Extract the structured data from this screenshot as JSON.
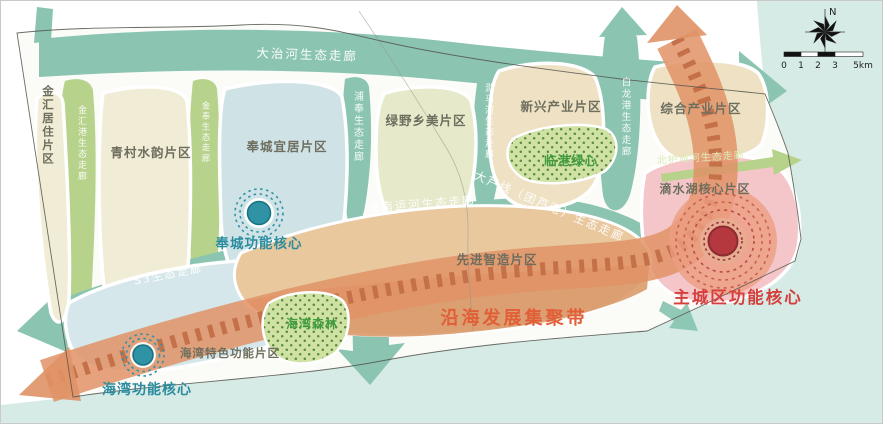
{
  "regions": {
    "jinhui_residential": "金汇居住片区",
    "qingcun_water": "青村水韵片区",
    "fengcheng_livable": "奉城宜居片区",
    "lvye_rural": "绿野乡美片区",
    "xinxing_industry": "新兴产业片区",
    "zonghe_industry": "综合产业片区",
    "dishuihu_core_area": "滴水湖核心片区",
    "advanced_manufacturing": "先进智造片区",
    "haiwan_special": "海湾特色功能片区"
  },
  "corridors": {
    "dazhihe": "大治河生态走廊",
    "jinhuigang": "金汇港生态走廊",
    "jinfeng": "金奉生态走廊",
    "pufeng": "浦奉生态走廊",
    "lemahe": "泐马河生态走廊",
    "bailonggang": "白龙港生态走廊",
    "punan_canal": "浦南运河生态走廊",
    "daluxian": "大芦线（团芦港）生态走廊",
    "s3": "S3生态走廊",
    "north_moat": "北护城河生态走廊"
  },
  "cores": {
    "fengcheng": "奉城功能核心",
    "haiwan": "海湾功能核心",
    "main_city": "主城区功能核心"
  },
  "belt": {
    "label": "沿海发展集聚带"
  },
  "green_spaces": {
    "lingang_green_heart": "临港绿心",
    "haiwan_forest": "海湾森林"
  },
  "compass": {
    "north": "N"
  },
  "scale_bar": {
    "labels": [
      "0",
      "1",
      "2",
      "3",
      "5km"
    ]
  },
  "colors": {
    "sea": "#d6eae6",
    "corridor_teal": "#8bc5b2",
    "corridor_green": "#b6d28b",
    "belt_orange": "#e09266",
    "belt_dash": "#c26f47",
    "zone_cream": "#f1ecd5",
    "zone_blue": "#cfe3e7",
    "zone_tan": "#eee1c4",
    "zone_pink": "#f4c6c9",
    "core_teal": "#2f93a5",
    "core_red": "#b4383e",
    "belt_text": "#e05f38",
    "core_teal_text": "#2a8c9e",
    "core_red_text": "#d43f3c",
    "green_text": "#3f9b3c"
  }
}
